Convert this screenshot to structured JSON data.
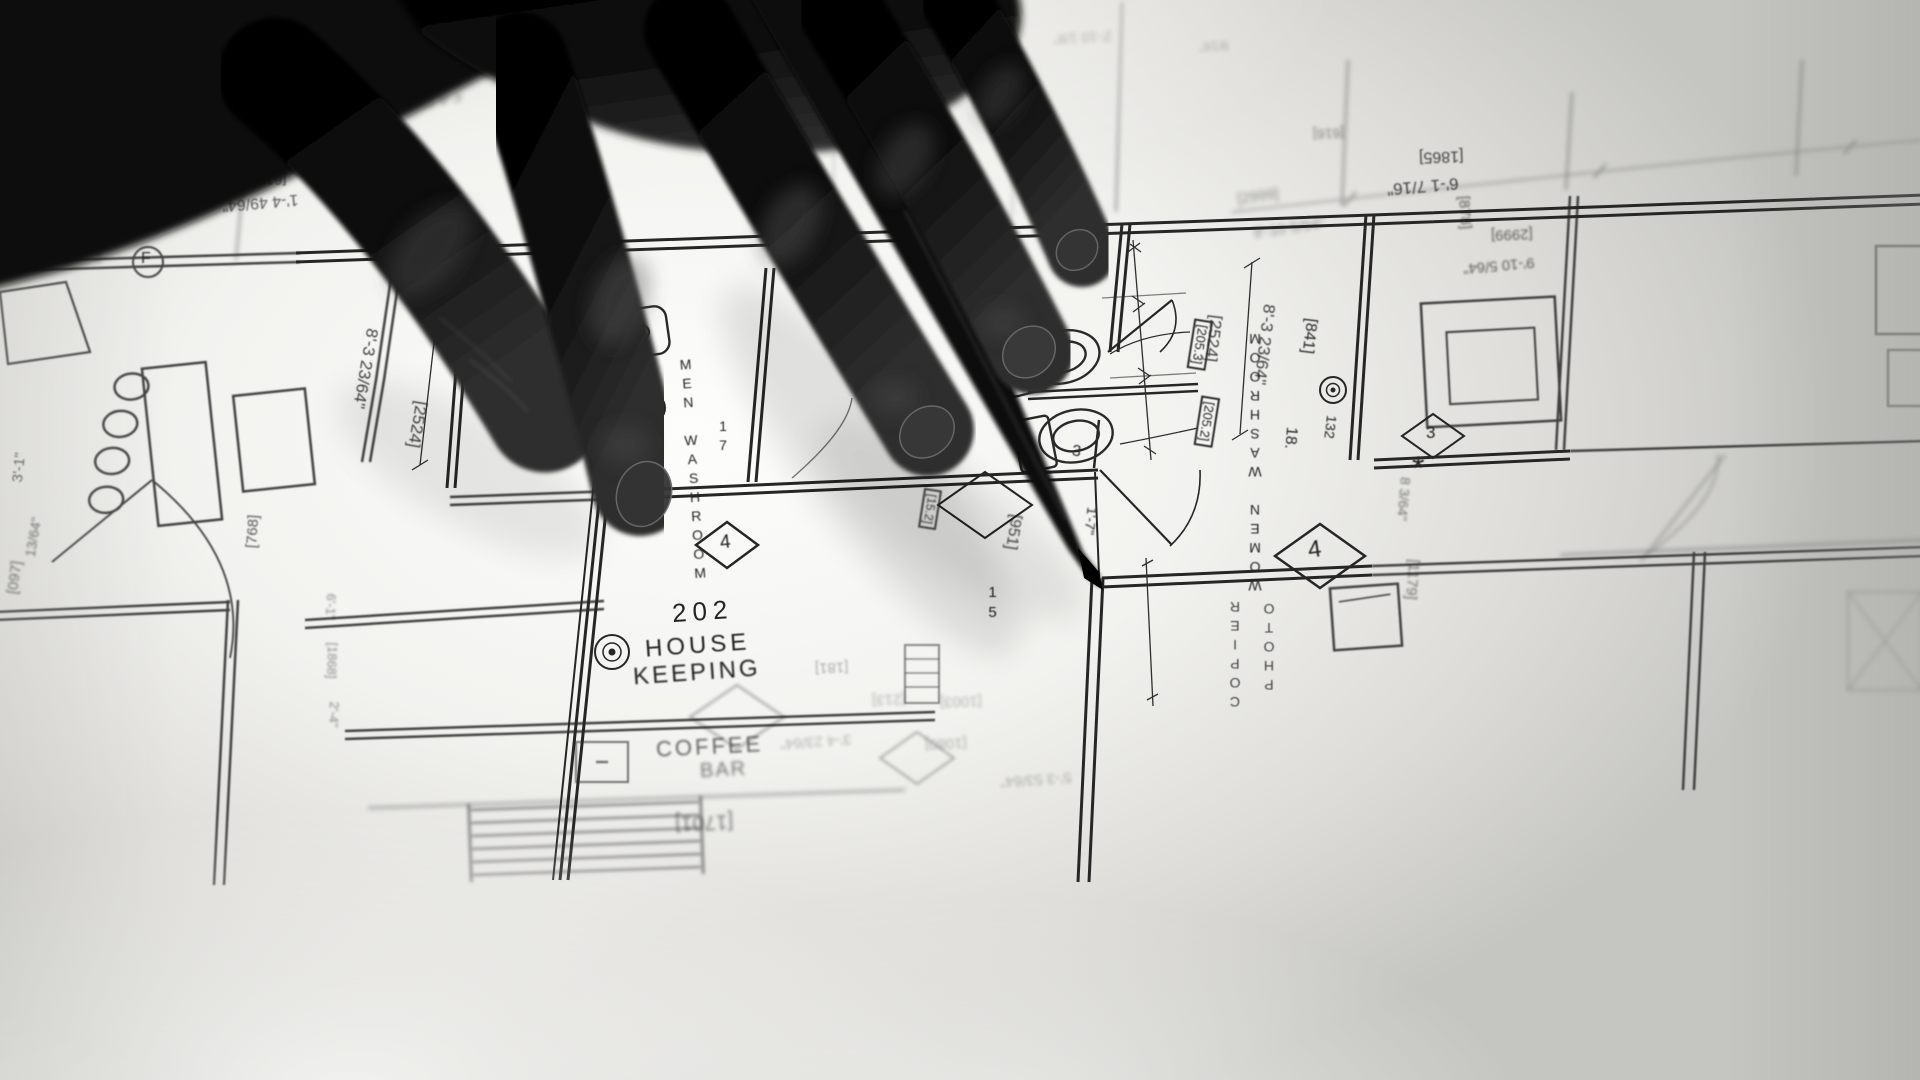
{
  "scene": {
    "type": "photograph",
    "subject": "hand holding a pen pointing at an architectural floor plan on a backlit light table",
    "style": "black-and-white"
  },
  "rooms": {
    "men_washroom": {
      "number": "17",
      "name": "MEN WASHROOM"
    },
    "women_washroom": {
      "number": "18.",
      "name": "WOMEN WASHROOM"
    },
    "housekeeping": {
      "number": "202",
      "line1": "HOUSE",
      "line2": "KEEPING"
    },
    "coffee_bar": {
      "line1": "COFFEE",
      "line2": "BAR"
    },
    "photo_copier": {
      "line1": "PHOTO",
      "line2": "COPIER"
    }
  },
  "keynotes": {
    "diamond_3": "3",
    "diamond_4": "4",
    "asterisk": "*",
    "circled_f": "F"
  },
  "tags": {
    "t205_3": "[205.3]",
    "t205_2": "[205.2]",
    "t841": "[841]",
    "t132": "132",
    "t951": "[951]",
    "t15": "15",
    "t15_2": "[15.2]",
    "t3": "3",
    "t1_7": "1'-7\""
  },
  "dimensions": {
    "d916": "[916]",
    "d6_10": "6'-10 1/2\"",
    "d512": "[512]",
    "d1_5": "1'-5 3/32\"",
    "d4_8": "4'-8 23/64\"",
    "d618": "[618]",
    "d1_4": "1'-4 49/64\"",
    "d619": "[619]",
    "d8_5": "8'-5 1/2\"",
    "d2_10": "2'-10 1/8\"",
    "d9_16": "9/16\"",
    "d616": "[616]",
    "d1865": "[1865]",
    "d6_1": "6'-1 7/16\"",
    "d2999": "[2999]",
    "d9_10": "9'-10 5/64\"",
    "d878": "[878]",
    "d2524": "[2524]",
    "d8_3": "8'-3 23/64\"",
    "d3_1": "3'-1\"",
    "d13_64": "13/64\"",
    "d097": "[097]",
    "d768": "[768]",
    "d6_1b": "6'-1\"",
    "d1868": "[1868]",
    "d2_4": "2'-4\"",
    "d8_3_64": "8 3/64\"",
    "d1179": "[1179]",
    "d1701": "[1701]",
    "d181": "[181]",
    "d213": "[213]",
    "d1003": "[1003]",
    "d3_4": "3'-4 23/64\"",
    "d1080": "[1080]",
    "d5_3": "5'-3 53/64\""
  },
  "colors": {
    "paper": "#cfcfcb",
    "ink": "#1d1d1d",
    "hand": "#0a0a0a",
    "nail": "#3c3c3c"
  }
}
